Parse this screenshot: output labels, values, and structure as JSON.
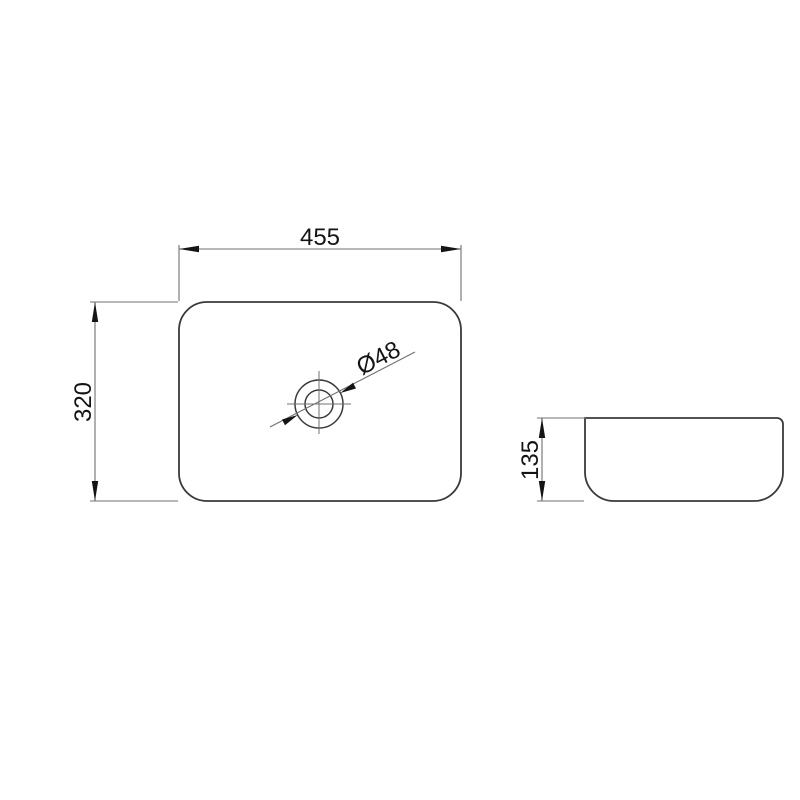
{
  "drawing": {
    "kind": "technical-dimension-drawing",
    "colors": {
      "background": "#ffffff",
      "object_line": "#3a3a3a",
      "dim_line": "#707070",
      "annotation": "#141414"
    },
    "top_view": {
      "width": "455",
      "depth": "320",
      "drain_diameter": "Ø48"
    },
    "side_view": {
      "height": "135"
    }
  }
}
